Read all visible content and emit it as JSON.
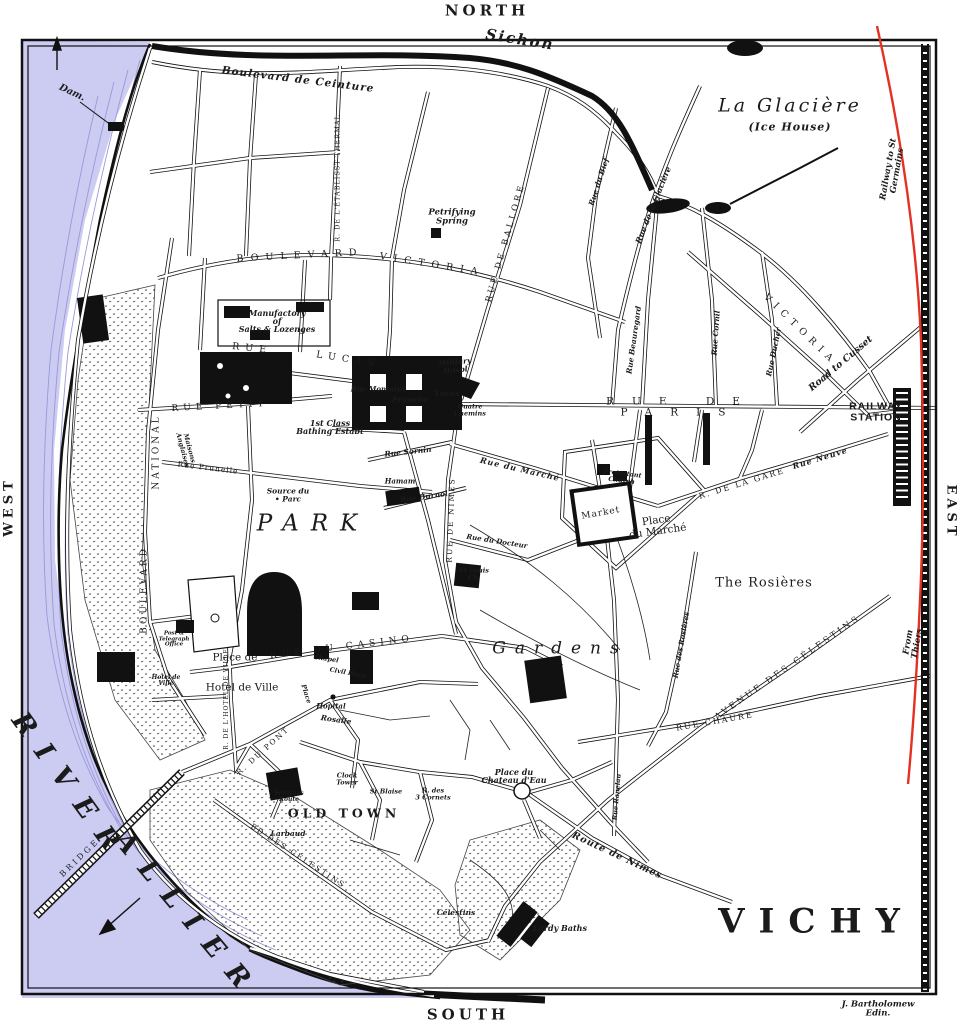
{
  "colors": {
    "paper": "#ffffff",
    "river": "#cccbf2",
    "river_hatch": "#9a98d8",
    "ink": "#1b1b1b",
    "railway_red": "#e33224"
  },
  "map_title": "VICHY",
  "credit": "J. Bartholomew Edin.",
  "labels": [
    {
      "name": "compass-north",
      "text": "NORTH",
      "x": 487,
      "y": 11,
      "fs": 15,
      "rot": 0,
      "ls": 4,
      "cls": "caps-bold"
    },
    {
      "name": "compass-south",
      "text": "SOUTH",
      "x": 468,
      "y": 1015,
      "fs": 15,
      "rot": 0,
      "ls": 4,
      "cls": "caps-bold"
    },
    {
      "name": "compass-west",
      "text": "WEST",
      "x": 9,
      "y": 507,
      "fs": 13,
      "rot": -90,
      "ls": 4,
      "cls": "caps-bold"
    },
    {
      "name": "compass-east",
      "text": "EAST",
      "x": 951,
      "y": 512,
      "fs": 13,
      "rot": 90,
      "ls": 4,
      "cls": "caps-bold"
    },
    {
      "name": "credit",
      "text": "J. Bartholomew Edin.",
      "x": 878,
      "y": 1009,
      "fs": 8.5,
      "rot": 0,
      "ls": 0,
      "cls": "script"
    },
    {
      "name": "title-vichy",
      "text": "VICHY",
      "x": 816,
      "y": 922,
      "fs": 34,
      "rot": 0,
      "ls": 14,
      "cls": "caps-bold"
    },
    {
      "name": "river-allier-1",
      "text": "RIVER",
      "x": 70,
      "y": 788,
      "fs": 27,
      "rot": 54,
      "ls": 16,
      "cls": "water-caps"
    },
    {
      "name": "river-allier-2",
      "text": "ALLIER",
      "x": 187,
      "y": 916,
      "fs": 27,
      "rot": 50,
      "ls": 16,
      "cls": "water-caps"
    },
    {
      "name": "bridge",
      "text": "BRIDGE",
      "x": 80,
      "y": 858,
      "fs": 8,
      "rot": -44,
      "ls": 3,
      "cls": "caps"
    },
    {
      "name": "dam",
      "text": "Dam.",
      "x": 72,
      "y": 93,
      "fs": 9.5,
      "rot": 25,
      "ls": 0,
      "cls": "script"
    },
    {
      "name": "sichon-river",
      "text": "Sichon",
      "x": 520,
      "y": 40,
      "fs": 15,
      "rot": 9,
      "ls": 2,
      "cls": "script"
    },
    {
      "name": "bd-ceinture",
      "text": "Boulevard de Ceinture",
      "x": 298,
      "y": 80,
      "fs": 10.5,
      "rot": 7,
      "ls": 1,
      "cls": "script"
    },
    {
      "name": "la-glaciere",
      "text": "La Glacière",
      "x": 790,
      "y": 106,
      "fs": 19,
      "rot": 0,
      "ls": 3,
      "cls": "place-italic"
    },
    {
      "name": "ice-house",
      "text": "(Ice House)",
      "x": 790,
      "y": 127,
      "fs": 11,
      "rot": 0,
      "ls": 1,
      "cls": "script"
    },
    {
      "name": "rue-glaciere",
      "text": "Rue de la Glacière",
      "x": 653,
      "y": 205,
      "fs": 8,
      "rot": -68,
      "ls": 0,
      "cls": "script"
    },
    {
      "name": "rwy-st-germains",
      "text": "Railway to St Germains",
      "x": 893,
      "y": 170,
      "fs": 8.5,
      "rot": -80,
      "ls": 0,
      "cls": "script"
    },
    {
      "name": "from-thiers",
      "text": "From Thiers",
      "x": 913,
      "y": 643,
      "fs": 8.5,
      "rot": -80,
      "ls": 0,
      "cls": "script"
    },
    {
      "name": "railway-station",
      "text": "RAILWAY\nSTATION",
      "x": 876,
      "y": 412,
      "fs": 10.5,
      "rot": 0,
      "ls": 1,
      "cls": "sans-bold"
    },
    {
      "name": "road-cusset",
      "text": "Road to Cusset",
      "x": 841,
      "y": 364,
      "fs": 9.5,
      "rot": -40,
      "ls": 0,
      "cls": "script"
    },
    {
      "name": "rue-de-paris",
      "text": "RUE DE PARIS",
      "x": 682,
      "y": 407,
      "fs": 10.5,
      "rot": 0,
      "ls": 18,
      "cls": "caps"
    },
    {
      "name": "bd-victoria-w1",
      "text": "BOULEVARD",
      "x": 300,
      "y": 256,
      "fs": 9.5,
      "rot": -3,
      "ls": 7,
      "cls": "caps"
    },
    {
      "name": "bd-victoria-w2",
      "text": "VICTORIA",
      "x": 432,
      "y": 265,
      "fs": 9.5,
      "rot": 9,
      "ls": 7,
      "cls": "caps"
    },
    {
      "name": "victoria-e",
      "text": "VICTORIA",
      "x": 800,
      "y": 330,
      "fs": 9.5,
      "rot": 44,
      "ls": 6,
      "cls": "caps"
    },
    {
      "name": "rue-ballore",
      "text": "RUE DE BALLORE",
      "x": 506,
      "y": 243,
      "fs": 8.5,
      "rot": -74,
      "ls": 3,
      "cls": "caps"
    },
    {
      "name": "rue-bief",
      "text": "Rue du Bief",
      "x": 599,
      "y": 182,
      "fs": 7.5,
      "rot": -72,
      "ls": 0,
      "cls": "script"
    },
    {
      "name": "rue-beauregard",
      "text": "Rue Beauregard",
      "x": 634,
      "y": 340,
      "fs": 7.5,
      "rot": -82,
      "ls": 0,
      "cls": "script"
    },
    {
      "name": "rue-cornil",
      "text": "Rue Cornil",
      "x": 716,
      "y": 333,
      "fs": 7.5,
      "rot": -86,
      "ls": 0,
      "cls": "script"
    },
    {
      "name": "rue-ducher",
      "text": "Rue Ducher",
      "x": 774,
      "y": 352,
      "fs": 7.5,
      "rot": -78,
      "ls": 0,
      "cls": "script"
    },
    {
      "name": "manufactory",
      "text": "Manufactory\nof\nSalts & Lozenges",
      "x": 277,
      "y": 321,
      "fs": 8,
      "rot": 0,
      "ls": 0,
      "cls": "script"
    },
    {
      "name": "rue-lucas-1",
      "text": "RUE",
      "x": 252,
      "y": 349,
      "fs": 9.5,
      "rot": 6,
      "ls": 6,
      "cls": "caps"
    },
    {
      "name": "rue-lucas-2",
      "text": "LUCAS",
      "x": 348,
      "y": 360,
      "fs": 9.5,
      "rot": 9,
      "ls": 6,
      "cls": "caps"
    },
    {
      "name": "rue-petit",
      "text": "RUE PETIT",
      "x": 220,
      "y": 407,
      "fs": 9,
      "rot": -3,
      "ls": 5,
      "cls": "caps"
    },
    {
      "name": "rue-prunelle",
      "text": "Rue Prunelle",
      "x": 208,
      "y": 468,
      "fs": 7.5,
      "rot": 7,
      "ls": 1,
      "cls": "caps"
    },
    {
      "name": "maisons-anglaises",
      "text": "Maisons\nAnglaises",
      "x": 186,
      "y": 449,
      "fs": 6.5,
      "rot": 75,
      "ls": 0,
      "cls": "script"
    },
    {
      "name": "bd-national-1",
      "text": "NATIONAL",
      "x": 157,
      "y": 452,
      "fs": 9,
      "rot": -90,
      "ls": 3,
      "cls": "caps"
    },
    {
      "name": "bd-national-2",
      "text": "BOULEVARD",
      "x": 145,
      "y": 590,
      "fs": 9,
      "rot": -90,
      "ls": 3,
      "cls": "caps"
    },
    {
      "name": "rue-thermal",
      "text": "R. DE L'ÉTABLISST THERMAL",
      "x": 338,
      "y": 178,
      "fs": 6.5,
      "rot": -90,
      "ls": 1,
      "cls": "caps"
    },
    {
      "name": "petrifying-spring",
      "text": "Petrifying\nSpring",
      "x": 452,
      "y": 217,
      "fs": 8.5,
      "rot": 0,
      "ls": 0,
      "cls": "script"
    },
    {
      "name": "military-hosp",
      "text": "Military\nHospl",
      "x": 455,
      "y": 366,
      "fs": 7.5,
      "rot": -5,
      "ls": 0,
      "cls": "script"
    },
    {
      "name": "lucas-spring",
      "text": "Lucas",
      "x": 447,
      "y": 394,
      "fs": 7.5,
      "rot": 0,
      "ls": 0,
      "cls": "script"
    },
    {
      "name": "prunelle-spring",
      "text": "Prunelle",
      "x": 410,
      "y": 400,
      "fs": 7.5,
      "rot": 0,
      "ls": 0,
      "cls": "script"
    },
    {
      "name": "rue-montaret",
      "text": "Rue Montaret",
      "x": 378,
      "y": 389,
      "fs": 7,
      "rot": 0,
      "ls": 0,
      "cls": "script"
    },
    {
      "name": "quatre-chemins",
      "text": "Quatre\nChemins",
      "x": 470,
      "y": 410,
      "fs": 6.5,
      "rot": 0,
      "ls": 0,
      "cls": "script"
    },
    {
      "name": "baths-1st-class",
      "text": "1st Class\nBathing Estabt",
      "x": 330,
      "y": 427,
      "fs": 8,
      "rot": 0,
      "ls": 0,
      "cls": "script"
    },
    {
      "name": "rue-sornin",
      "text": "Rue Sornin",
      "x": 408,
      "y": 452,
      "fs": 7.5,
      "rot": -6,
      "ls": 0,
      "cls": "script"
    },
    {
      "name": "hamam",
      "text": "Hamam",
      "x": 400,
      "y": 481,
      "fs": 7,
      "rot": 0,
      "ls": 0,
      "cls": "script"
    },
    {
      "name": "rue-burnol",
      "text": "Rue Burnol",
      "x": 424,
      "y": 497,
      "fs": 7.5,
      "rot": -8,
      "ls": 0,
      "cls": "script"
    },
    {
      "name": "rue-du-marche",
      "text": "Rue du Marché",
      "x": 520,
      "y": 469,
      "fs": 8,
      "rot": 13,
      "ls": 1,
      "cls": "script"
    },
    {
      "name": "rue-docteur",
      "text": "Rue du Docteur",
      "x": 497,
      "y": 541,
      "fs": 7,
      "rot": 9,
      "ls": 0,
      "cls": "script"
    },
    {
      "name": "source-du-parc",
      "text": "Source du\n• Parc",
      "x": 288,
      "y": 495,
      "fs": 7.5,
      "rot": 0,
      "ls": 0,
      "cls": "script"
    },
    {
      "name": "park",
      "text": "PARK",
      "x": 313,
      "y": 524,
      "fs": 23,
      "rot": 0,
      "ls": 12,
      "cls": "place-italic"
    },
    {
      "name": "rue-du-casino",
      "text": "RUE DU CASINO",
      "x": 342,
      "y": 648,
      "fs": 9,
      "rot": -7,
      "ls": 5,
      "cls": "caps"
    },
    {
      "name": "gardens",
      "text": "Gardens",
      "x": 560,
      "y": 649,
      "fs": 17,
      "rot": 0,
      "ls": 9,
      "cls": "place-italic"
    },
    {
      "name": "the-rosieres",
      "text": "The Rosières",
      "x": 764,
      "y": 583,
      "fs": 13,
      "rot": 0,
      "ls": 1,
      "cls": "place"
    },
    {
      "name": "market",
      "text": "Market",
      "x": 601,
      "y": 514,
      "fs": 9,
      "rot": -10,
      "ls": 1,
      "cls": "place"
    },
    {
      "name": "place-du-marche",
      "text": "Place\ndu Marché",
      "x": 657,
      "y": 526,
      "fs": 10.5,
      "rot": -8,
      "ls": 0,
      "cls": "place"
    },
    {
      "name": "protestant-church",
      "text": "Protestant\nChurch",
      "x": 622,
      "y": 477,
      "fs": 6.5,
      "rot": 7,
      "ls": 0,
      "cls": "script"
    },
    {
      "name": "rue-de-la-gare",
      "text": "R. DE LA GARE",
      "x": 742,
      "y": 484,
      "fs": 8,
      "rot": -17,
      "ls": 2,
      "cls": "caps"
    },
    {
      "name": "rue-neuve",
      "text": "Rue Neuve",
      "x": 820,
      "y": 458,
      "fs": 8,
      "rot": -17,
      "ls": 1,
      "cls": "script"
    },
    {
      "name": "st-louis-church",
      "text": "St Louis\nCh.",
      "x": 474,
      "y": 574,
      "fs": 6.5,
      "rot": 0,
      "ls": 0,
      "cls": "script"
    },
    {
      "name": "rue-de-nimes",
      "text": "RUE DE NIMES",
      "x": 451,
      "y": 520,
      "fs": 7.5,
      "rot": -88,
      "ls": 2,
      "cls": "caps"
    },
    {
      "name": "route-de-nimes",
      "text": "Route de Nimes",
      "x": 617,
      "y": 856,
      "fs": 9.5,
      "rot": 25,
      "ls": 1,
      "cls": "script"
    },
    {
      "name": "av-celestins",
      "text": "AVENUE DES CÉLESTINS",
      "x": 788,
      "y": 668,
      "fs": 8.5,
      "rot": -35,
      "ls": 3,
      "cls": "caps"
    },
    {
      "name": "rue-chaure",
      "text": "RUE CHAURE",
      "x": 715,
      "y": 722,
      "fs": 8,
      "rot": -10,
      "ls": 2,
      "cls": "caps"
    },
    {
      "name": "rue-des-rosieres",
      "text": "Rue des Rosières",
      "x": 681,
      "y": 645,
      "fs": 7,
      "rot": -80,
      "ls": 0,
      "cls": "script"
    },
    {
      "name": "rue-ranelau",
      "text": "Rue Ranelau",
      "x": 617,
      "y": 797,
      "fs": 6.5,
      "rot": -85,
      "ls": 0,
      "cls": "script"
    },
    {
      "name": "old-town",
      "text": "OLD TOWN",
      "x": 344,
      "y": 814,
      "fs": 12.5,
      "rot": 0,
      "ls": 4,
      "cls": "caps-bold"
    },
    {
      "name": "clock-tower",
      "text": "Clock\nTower",
      "x": 347,
      "y": 779,
      "fs": 6.5,
      "rot": 0,
      "ls": 0,
      "cls": "script"
    },
    {
      "name": "st-blaise",
      "text": "St Blaise",
      "x": 386,
      "y": 792,
      "fs": 6.5,
      "rot": 0,
      "ls": 0,
      "cls": "script"
    },
    {
      "name": "trois-cornets",
      "text": "R. des\n3 Cornets",
      "x": 433,
      "y": 794,
      "fs": 6.5,
      "rot": 0,
      "ls": 0,
      "cls": "script"
    },
    {
      "name": "place-chateau-eau",
      "text": "Place du\nChateau d'Eau",
      "x": 514,
      "y": 776,
      "fs": 8,
      "rot": 0,
      "ls": 0,
      "cls": "script"
    },
    {
      "name": "larbaud",
      "text": "Larbaud",
      "x": 288,
      "y": 834,
      "fs": 7.5,
      "rot": 0,
      "ls": 0,
      "cls": "script"
    },
    {
      "name": "serignes-route",
      "text": "Serignes\nRoute",
      "x": 289,
      "y": 797,
      "fs": 6,
      "rot": 0,
      "ls": 0,
      "cls": "script"
    },
    {
      "name": "bd-celestins",
      "text": "BD DES CÉLESTINS",
      "x": 298,
      "y": 856,
      "fs": 7.5,
      "rot": 33,
      "ls": 2,
      "cls": "caps"
    },
    {
      "name": "celestins",
      "text": "Celestins",
      "x": 456,
      "y": 913,
      "fs": 7.5,
      "rot": 0,
      "ls": 0,
      "cls": "script"
    },
    {
      "name": "lardy-baths",
      "text": "Lardy Baths",
      "x": 560,
      "y": 928,
      "fs": 8,
      "rot": 0,
      "ls": 0,
      "cls": "script"
    },
    {
      "name": "place-de",
      "text": "Place de",
      "x": 235,
      "y": 658,
      "fs": 10.5,
      "rot": 0,
      "ls": 0,
      "cls": "place"
    },
    {
      "name": "place-hotel-de-ville",
      "text": "Hotel de Ville",
      "x": 242,
      "y": 688,
      "fs": 10.5,
      "rot": 0,
      "ls": 0,
      "cls": "place"
    },
    {
      "name": "hotel-de-ville-bldg",
      "text": "Hotel de\nVille",
      "x": 166,
      "y": 681,
      "fs": 6,
      "rot": 0,
      "ls": 0,
      "cls": "script"
    },
    {
      "name": "post-telegraph",
      "text": "Post &\nTelegraph\nOffice",
      "x": 174,
      "y": 640,
      "fs": 5.5,
      "rot": 0,
      "ls": 0,
      "cls": "script"
    },
    {
      "name": "chapel",
      "text": "Chapel",
      "x": 326,
      "y": 659,
      "fs": 6.5,
      "rot": 8,
      "ls": 0,
      "cls": "script"
    },
    {
      "name": "civil-hosp",
      "text": "Civil Hosp",
      "x": 348,
      "y": 673,
      "fs": 6.5,
      "rot": 10,
      "ls": 0,
      "cls": "script"
    },
    {
      "name": "place-rosalie-1",
      "text": "Place",
      "x": 306,
      "y": 694,
      "fs": 6.5,
      "rot": 72,
      "ls": 0,
      "cls": "script"
    },
    {
      "name": "hopital",
      "text": "Hopital",
      "x": 331,
      "y": 706,
      "fs": 7,
      "rot": 0,
      "ls": 0,
      "cls": "script"
    },
    {
      "name": "place-rosalie-2",
      "text": "Rosalie",
      "x": 336,
      "y": 720,
      "fs": 7.5,
      "rot": 8,
      "ls": 0,
      "cls": "script"
    },
    {
      "name": "rue-du-pont",
      "text": "R. DU PONT",
      "x": 263,
      "y": 751,
      "fs": 7.5,
      "rot": -42,
      "ls": 2,
      "cls": "caps"
    },
    {
      "name": "rue-hotel-de-ville",
      "text": "R. DE L'HOTEL DE VILLE",
      "x": 227,
      "y": 699,
      "fs": 6,
      "rot": -90,
      "ls": 1,
      "cls": "caps"
    }
  ]
}
